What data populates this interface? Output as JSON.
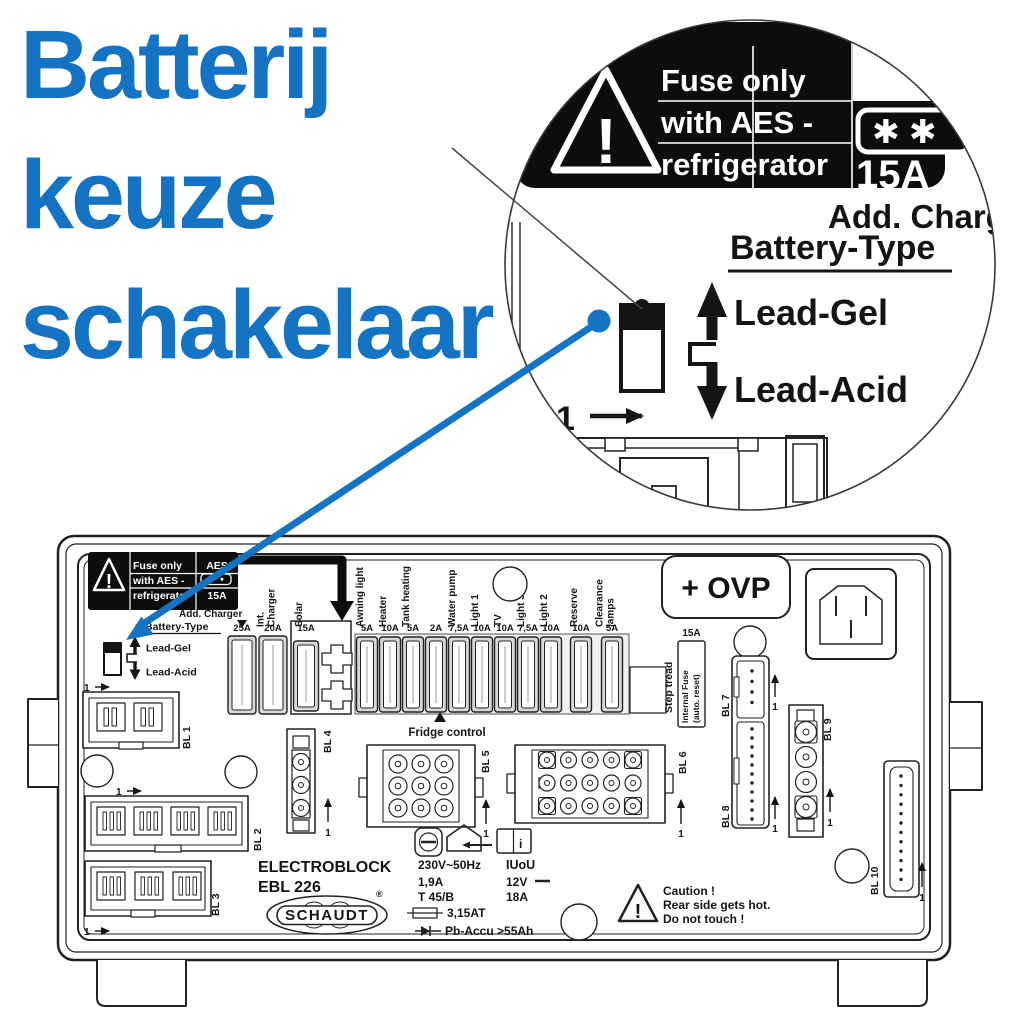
{
  "title": {
    "lines": [
      "Batterij",
      "keuze",
      "schakelaar"
    ]
  },
  "colors": {
    "accent_blue": "#1573C4",
    "diagram_line": "#222222",
    "label_black": "#0d0d0d"
  },
  "inset": {
    "warning": {
      "line1": "Fuse only",
      "line2": "with AES -",
      "line3": "refrigerator",
      "stars": "✱ ✱",
      "rating": "15A"
    },
    "add_charger": "Add. Charger",
    "battery_type": "Battery-Type",
    "lead_gel": "Lead-Gel",
    "lead_acid": "Lead-Acid",
    "pin_one": "1"
  },
  "board": {
    "warning": {
      "line1": "Fuse only",
      "line2": "with AES -",
      "line3": "refrigerator",
      "aes": "AES",
      "rating": "15A"
    },
    "add_charger": "Add. Charger",
    "battery_type": "Battery-Type",
    "lead_gel": "Lead-Gel",
    "lead_acid": "Lead-Acid",
    "pin_one": "1",
    "fuses": [
      {
        "name": [],
        "amp": "25A"
      },
      {
        "name": [
          "Int.",
          "Charger"
        ],
        "amp": "20A"
      },
      {
        "name": [
          "Solar"
        ],
        "amp": "15A"
      },
      {
        "name": [
          "Awning light"
        ],
        "amp": "5A"
      },
      {
        "name": [
          "Heater"
        ],
        "amp": "10A"
      },
      {
        "name": [
          "Tank heating"
        ],
        "amp": "5A"
      },
      {
        "name": [],
        "amp": "2A"
      },
      {
        "name": [
          "Water pump"
        ],
        "amp": "7,5A"
      },
      {
        "name": [
          "Light 1"
        ],
        "amp": "10A"
      },
      {
        "name": [
          "TV"
        ],
        "amp": "10A"
      },
      {
        "name": [
          "Light 3"
        ],
        "amp": "7,5A"
      },
      {
        "name": [
          "Light 2"
        ],
        "amp": "10A"
      },
      {
        "name": [
          "Reserve"
        ],
        "amp": "10A"
      },
      {
        "name": [
          "Clearance",
          "lamps"
        ],
        "amp": "5A"
      }
    ],
    "fridge_control": "Fridge control",
    "step_tread": "Step tread",
    "internal_fuse": {
      "rating": "15A",
      "line1": "Internal Fuse",
      "line2": "(auto. reset)"
    },
    "ovp": "+ OVP",
    "connectors": [
      {
        "label": "BL 1"
      },
      {
        "label": "BL 2"
      },
      {
        "label": "BL 3"
      },
      {
        "label": "BL 4"
      },
      {
        "label": "BL 5"
      },
      {
        "label": "BL 6"
      },
      {
        "label": "BL 7"
      },
      {
        "label": "BL 8"
      },
      {
        "label": "BL 9"
      },
      {
        "label": "BL 10"
      }
    ],
    "model": {
      "brand_block": "ELECTROBLOCK",
      "model_no": "EBL 226",
      "logo": "SCHAUDT",
      "reg": "®"
    },
    "specs_left": [
      "230V~50Hz",
      "1,9A",
      "T 45/B"
    ],
    "fuse_spec": "3,15AT",
    "battery_spec": "Pb-Accu >55Ah",
    "specs_right": [
      "IUoU",
      "12V",
      "18A"
    ],
    "book_i": "i",
    "caution": [
      "Caution !",
      "Rear side gets hot.",
      "Do not touch !"
    ]
  }
}
